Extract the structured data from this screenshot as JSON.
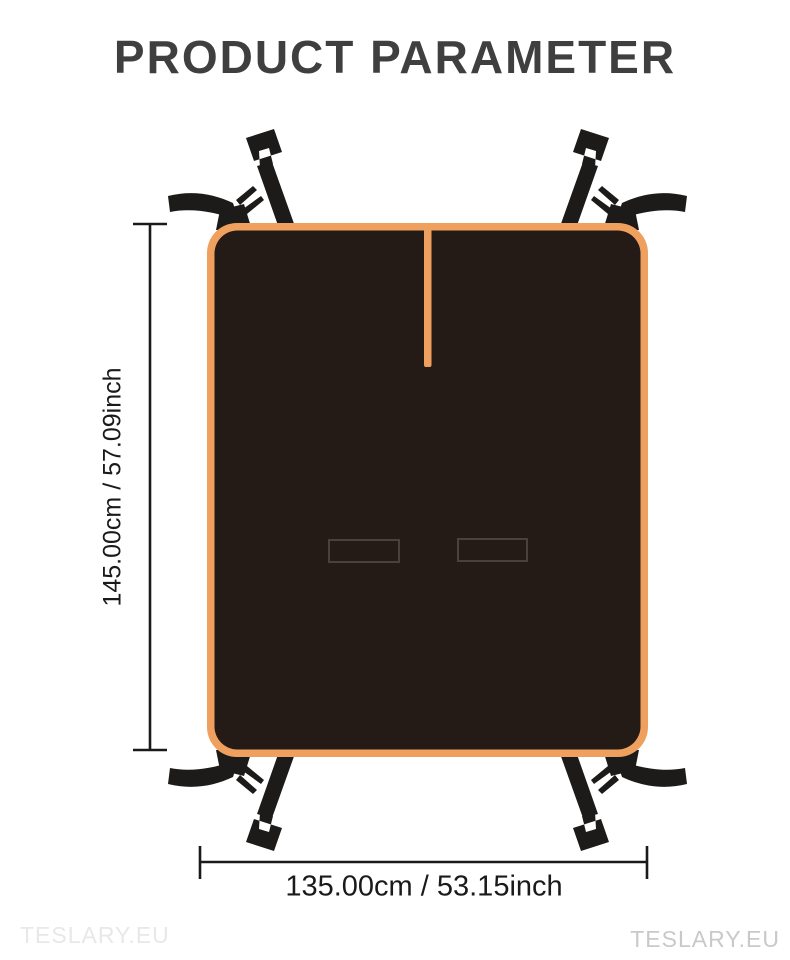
{
  "page": {
    "title": "PRODUCT PARAMETER"
  },
  "dimensions": {
    "height": {
      "label": "145.00cm / 57.09inch",
      "cm": 145.0,
      "inch": 57.09
    },
    "width": {
      "label": "135.00cm / 53.15inch",
      "cm": 135.0,
      "inch": 53.15
    }
  },
  "watermarks": {
    "left": "TESLARY.EU",
    "right": "TESLARY.EU"
  },
  "colors": {
    "background": "#ffffff",
    "mat_border_orange": "#efa05e",
    "mat_surface_dark": "#241a16",
    "strap_black": "#1d1b19",
    "slit_outline": "#4a4239",
    "dimension_line": "#1a1a1a",
    "title_text": "#3f3f3f"
  }
}
